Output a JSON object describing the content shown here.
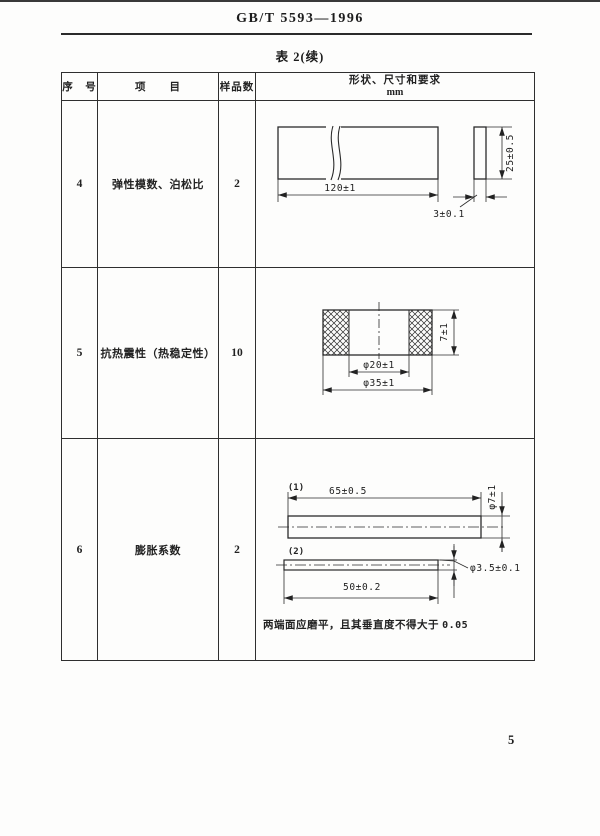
{
  "page": {
    "doc_number": "GB/T 5593—1996",
    "table_title": "表 2(续)",
    "page_number": "5"
  },
  "table": {
    "col_headers": {
      "no": "序　号",
      "item": "项　　目",
      "samples": "样品数",
      "shape": "形状、尺寸和要求",
      "unit": "mm"
    },
    "rows": [
      {
        "no": "4",
        "item": "弹性模数、泊松比",
        "samples": "2"
      },
      {
        "no": "5",
        "item": "抗热震性（热稳定性）",
        "samples": "10"
      },
      {
        "no": "6",
        "item": "膨胀系数",
        "samples": "2"
      }
    ]
  },
  "drawings": {
    "row4": {
      "length": "120±1",
      "height": "25±0.5",
      "thickness": "3±0.1"
    },
    "row5": {
      "inner_diameter": "φ20±1",
      "outer_diameter": "φ35±1",
      "height": "7±1"
    },
    "row6": {
      "fig1_label": "(1)",
      "fig1_length": "65±0.5",
      "fig1_diameter": "φ7±1",
      "fig2_label": "(2)",
      "fig2_length": "50±0.2",
      "fig2_diameter": "φ3.5±0.1",
      "note": "两端面应磨平，且其垂直度不得大于",
      "note_value": "0.05"
    }
  }
}
